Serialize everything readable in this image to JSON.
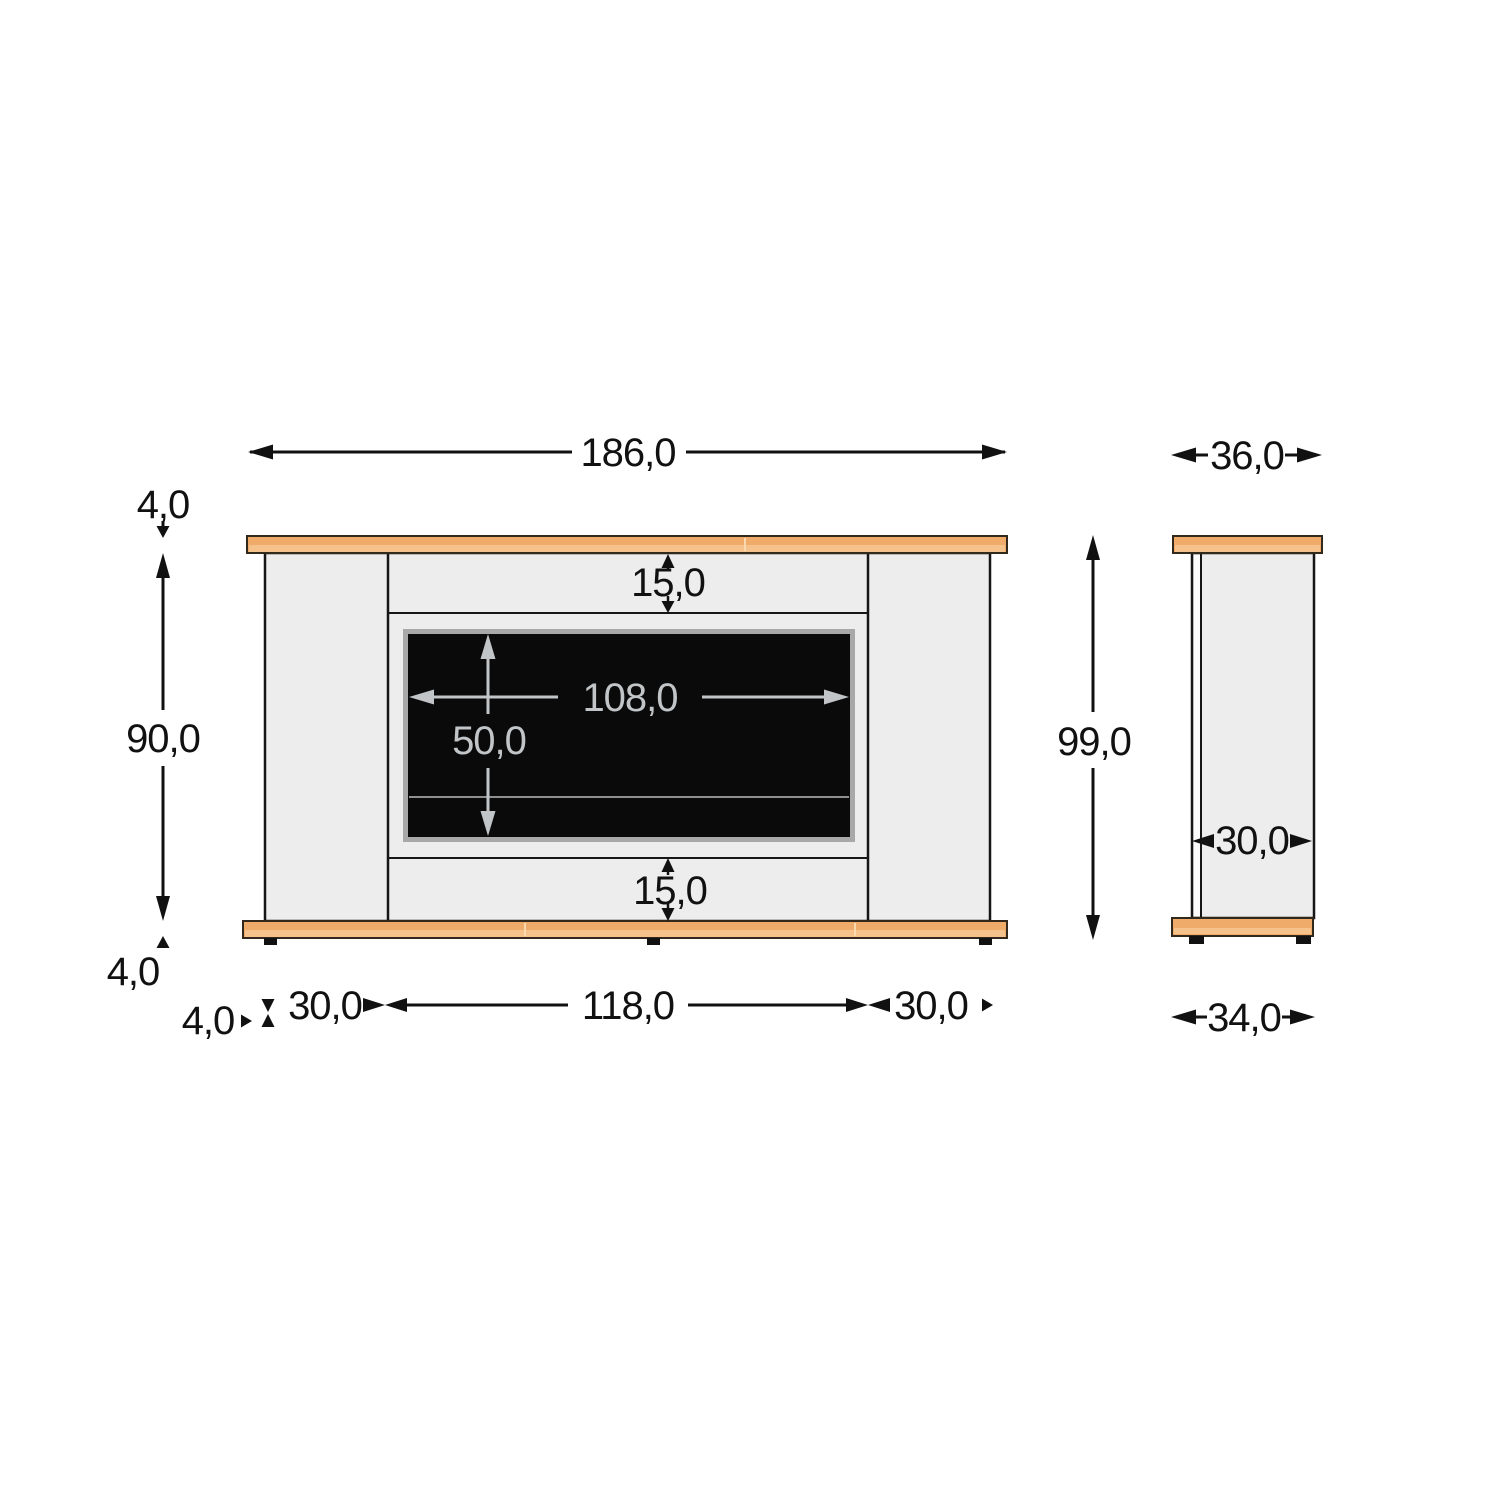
{
  "drawing": {
    "front_view": {
      "overall_width": "186,0",
      "top_board_thickness": "4,0",
      "body_height": "90,0",
      "bottom_board_thickness": "4,0",
      "top_reveal": "15,0",
      "bottom_reveal": "15,0",
      "firebox_width": "108,0",
      "firebox_height": "50,0",
      "base_overhang": "4,0",
      "left_pillar_width": "30,0",
      "center_width": "118,0",
      "right_pillar_width": "30,0"
    },
    "side_view": {
      "top_depth": "36,0",
      "overall_height": "99,0",
      "body_depth": "30,0",
      "base_depth": "34,0"
    }
  },
  "colors": {
    "wood": "#efab69",
    "wood_light": "#f5c28b",
    "wood_seam": "#f9d9ad",
    "panel": "#ededed",
    "panel_strip": "#fbfbfb",
    "firebox_black": "#0a0a0a",
    "firebox_frame": "#a8a8a8",
    "fuel_line": "#8f8f8f",
    "dim_black": "#111111",
    "dim_gray": "#c1c5c8",
    "foot_black": "#111111"
  }
}
